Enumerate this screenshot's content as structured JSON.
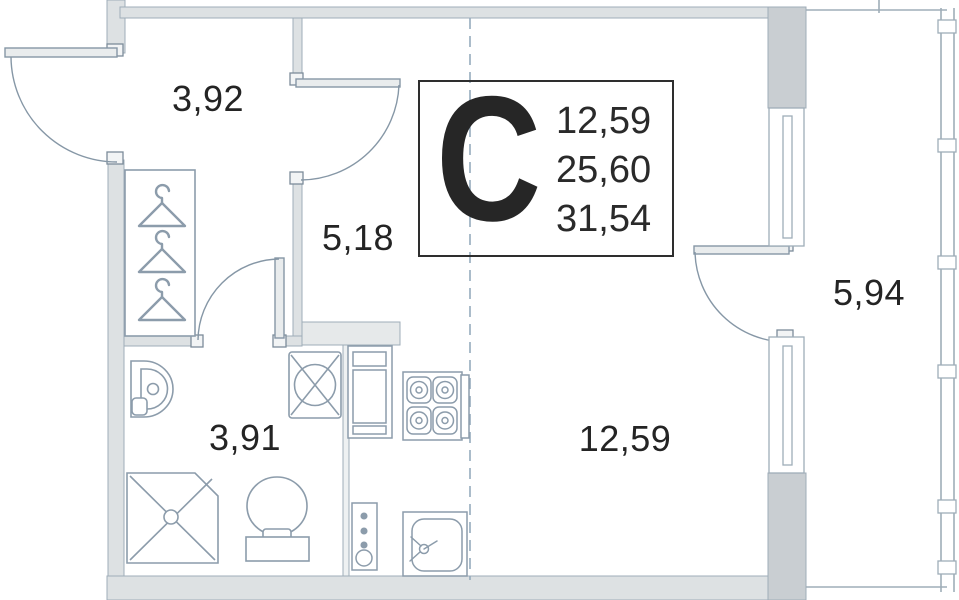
{
  "plan": {
    "title": "studio apartment floor plan",
    "type_label": "С",
    "info_box": {
      "values": [
        "12,59",
        "25,60",
        "31,54"
      ]
    },
    "rooms": [
      {
        "id": "entry-hall",
        "area": "3,92"
      },
      {
        "id": "corridor",
        "area": "5,18"
      },
      {
        "id": "bathroom",
        "area": "3,91"
      },
      {
        "id": "living-kitchen",
        "area": "12,59"
      },
      {
        "id": "balcony",
        "area": "5,94"
      }
    ],
    "fixtures": [
      "entrance-door",
      "interior-door",
      "bathroom-door",
      "balcony-door",
      "wardrobe-hangers",
      "washbasin",
      "washing-machine",
      "shower",
      "toilet",
      "kitchen-cabinet",
      "stove",
      "kitchen-sink",
      "riser-pipes",
      "window",
      "balcony-glazing",
      "section-dashed-line"
    ],
    "colors": {
      "wall_fill": "#dde1e3",
      "wall_dark_fill": "#c9ced2",
      "wall_stroke": "#9fadb8",
      "fixture_stroke": "#8c9cab",
      "duct_fill": "#e6e9ea",
      "dashed_line": "#96abbd",
      "text": "#242424",
      "box_border": "#2e2e2e"
    }
  }
}
